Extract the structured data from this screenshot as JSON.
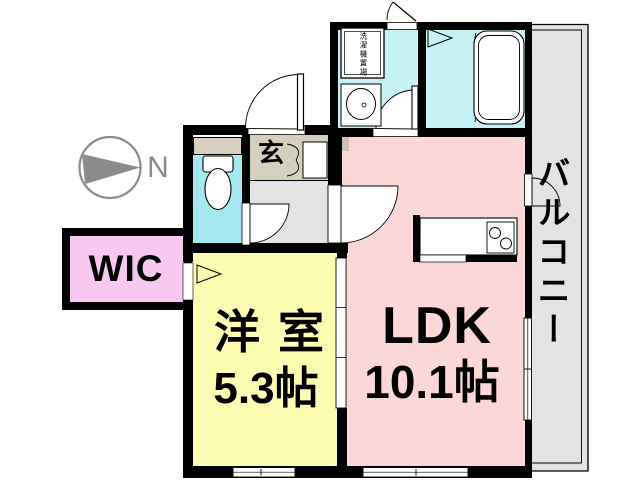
{
  "plan": {
    "compass": {
      "label": "N"
    },
    "rooms": {
      "ldk": {
        "label": "LDK",
        "size": "10.1帖"
      },
      "western": {
        "label": "洋室",
        "size": "5.3帖"
      },
      "wic": {
        "label": "WIC"
      },
      "entrance": {
        "label": "玄"
      },
      "balcony": {
        "label": "バルコニー"
      },
      "laundry": {
        "label": "洗濯機置場"
      }
    },
    "colors": {
      "wall": "#000000",
      "ldk_pink": "#FBD7D7",
      "western_yellow": "#FCFCB3",
      "wic_pink": "#F8C8F0",
      "entrance_beige": "#D5CFBF",
      "hallway_gray": "#E3E3E3",
      "balcony_gray": "#E3E3E3",
      "toilet_cyan": "#A6E7F0",
      "bath_cyan": "#C7F2F5",
      "compass_gray": "#8B8B8B"
    },
    "icons": [
      "north-compass-icon",
      "toilet-icon",
      "bathtub-icon",
      "sink-icon",
      "stove-icon",
      "washing-machine-icon",
      "door-swing-icon",
      "sliding-door-icon",
      "window-icon"
    ]
  }
}
